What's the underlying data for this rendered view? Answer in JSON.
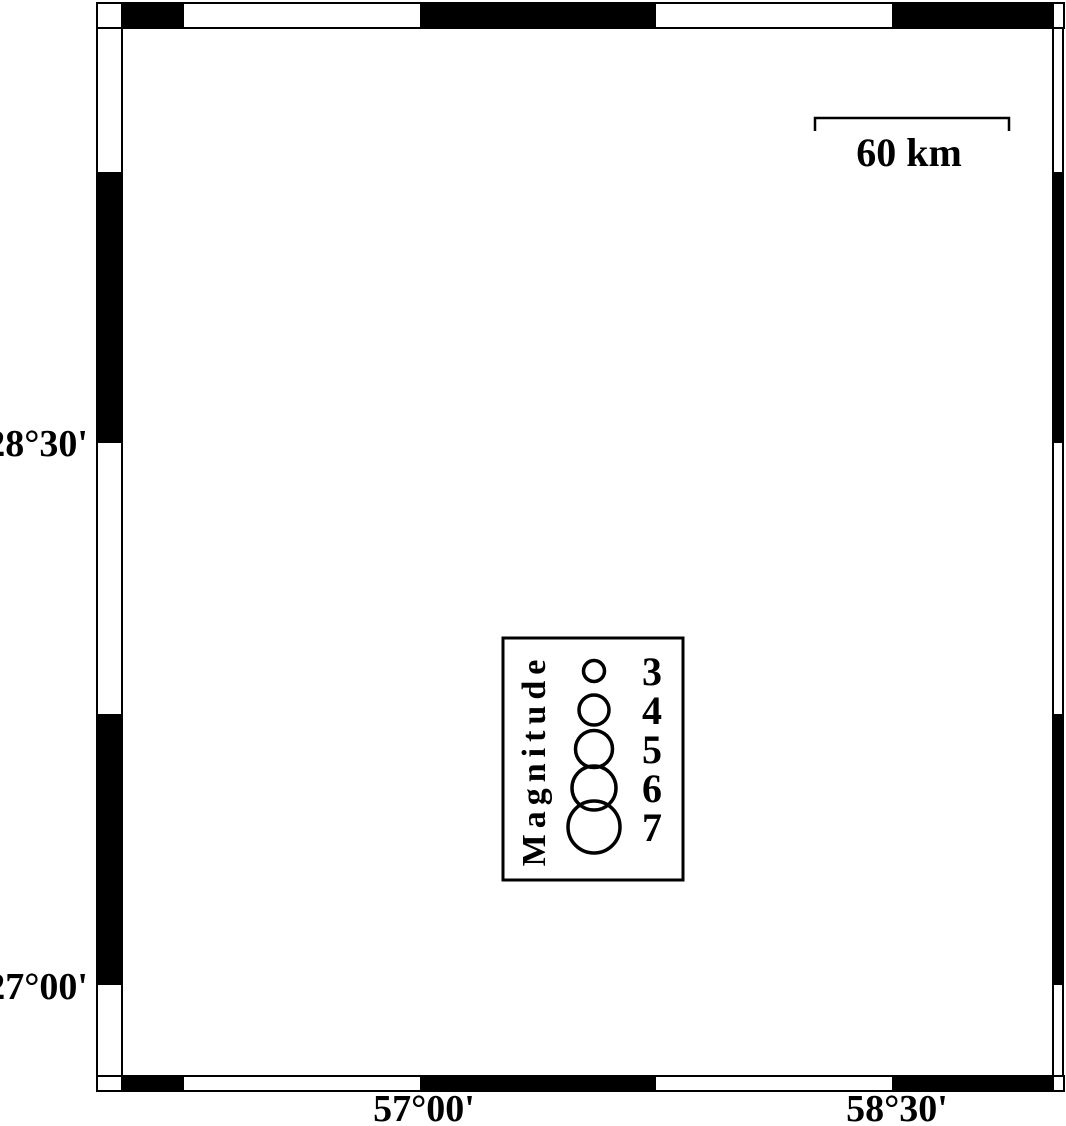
{
  "map": {
    "kind": "seismicity-map",
    "axis": {
      "lat_labels": [
        {
          "text": "28°30'",
          "tick_y": 443
        },
        {
          "text": "27°00'",
          "tick_y": 985
        }
      ],
      "lon_labels": [
        {
          "text": "57°00'",
          "tick_x": 420
        },
        {
          "text": "58°30'",
          "tick_x": 892
        }
      ]
    },
    "scale_bar": {
      "label": "60 km"
    },
    "legend": {
      "title": "Magnitude",
      "entries": [
        {
          "magnitude": "3",
          "radius": 10.5
        },
        {
          "magnitude": "4",
          "radius": 15
        },
        {
          "magnitude": "5",
          "radius": 18.5
        },
        {
          "magnitude": "6",
          "radius": 22
        },
        {
          "magnitude": "7",
          "radius": 26
        }
      ]
    },
    "earthquakes": {
      "color": "#fb0909",
      "outline": "#000000",
      "clusters": [
        {
          "name": "central-cluster",
          "points": [
            [
              558,
              532,
              13
            ],
            [
              570,
              534,
              13
            ],
            [
              556,
              544,
              13
            ],
            [
              581,
              546,
              13
            ],
            [
              533,
              547,
              14
            ],
            [
              576,
              566,
              13
            ],
            [
              591,
              569,
              13
            ]
          ]
        },
        {
          "name": "northeast-cluster",
          "points": [
            [
              973,
              343,
              13
            ],
            [
              988,
              357,
              12
            ],
            [
              968,
              361,
              13
            ],
            [
              978,
              351,
              11
            ]
          ]
        }
      ]
    },
    "station": {
      "x": 158,
      "y": 828,
      "symbol": "triangle",
      "fill": "#c4c4c4",
      "inner_fill": "#111111"
    },
    "colors": {
      "water": "#57aef2",
      "coast_outline": "#0b2f86",
      "land": "#ffffff",
      "frame": "#000000",
      "boundary_line": "#1a1a1a",
      "gridline_faint": "#ccdded"
    }
  }
}
